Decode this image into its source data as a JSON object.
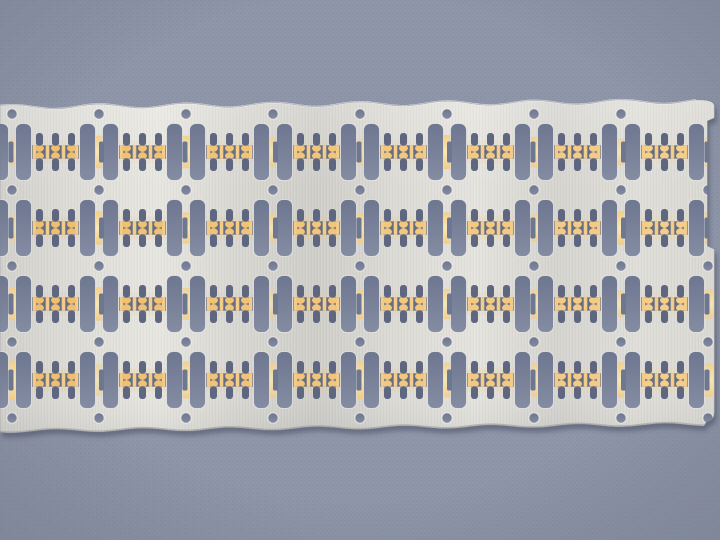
{
  "scene": {
    "type": "photograph",
    "subject": "Stamped metal semiconductor lead frame strip with selective gold plating, lying on a blue-gray woven surface",
    "lighting": "soft top light, slight shadow under lower edge, brushed-metal sheen"
  },
  "palette": {
    "background": "#8F96A8",
    "background_weave": "#838BA0",
    "vignette": "rgba(42,48,66,0.14)",
    "shadow": "#3A4054",
    "metal_stops": [
      "#D2D1CC",
      "#DEDDD7",
      "#E7E6E0",
      "#D8D7D1",
      "#CFCEC9",
      "#DCDBD5",
      "#E4E3DD",
      "#D5D4CF",
      "#DFDED8",
      "#D9D8D2"
    ],
    "metal_top_sheen": "rgba(255,255,255,0.20)",
    "metal_bottom_shade": "rgba(80,82,92,0.10)",
    "edge_highlight": "#F7F6F1",
    "edge_bottom": "#A9A9A6",
    "outline": "rgba(118,124,140,0.55)",
    "rim": "rgba(248,247,242,0.62)",
    "hole_top": "#6E7790",
    "hole_bottom": "#848CA2",
    "cluster_band": "#666E86",
    "cluster_hole": "#5E6680",
    "gold_lead_left": "#EFBD6C",
    "gold_lead_right": "#F5CF8C",
    "gold_bar": "#F2CC88",
    "strip_stops": [
      "#F3CE86",
      "#F9E8B8",
      "#F2CB82"
    ],
    "band_stops": [
      "#EFC27E",
      "#F3CA86",
      "#F7DA9A"
    ],
    "band_opacity_by_row": [
      0.15,
      0.3,
      0.19,
      0.31
    ]
  },
  "pattern": {
    "canvas": {
      "width": 720,
      "height": 540
    },
    "plate": {
      "top_y_left": 107,
      "top_slope": 6,
      "top_wave_amp": 2.2,
      "bottom_y_left": 431.5,
      "bottom_slope": 7,
      "bottom_wave_amp": 1.6,
      "right_x": 714.5,
      "notch_x": 707.5,
      "notch_y1": 121,
      "notch_y2": 246,
      "corner_step_y": 412,
      "corner_inset_x": 706.5,
      "corner_bottom_y": 422
    },
    "grid": {
      "hole_x0": 12,
      "pitch_x": 87,
      "hole_cols": 9,
      "hole_y0": 114,
      "pitch_y": 76,
      "hole_rows": 5,
      "lead_row_y0": 152,
      "lead_rows": 4,
      "cell_i_min": -1,
      "cell_i_max": 7,
      "sprocket_radius": 5.2,
      "skip_holes": [
        [
          8,
          0
        ]
      ]
    },
    "slot": {
      "body_half_in": 24,
      "body_half_out": 40,
      "body_h": 57,
      "body_rx": 6.5,
      "notch_w": 3.5,
      "notch_h": 21,
      "notch_rx": 1.8
    },
    "strip": {
      "base_w": 9,
      "base_h": 26,
      "rx": 3
    },
    "band": {
      "h": 23
    },
    "cluster": {
      "col_offsets": [
        -16,
        0,
        16
      ],
      "hole_w": 7,
      "hole_h": 12.8,
      "hole_gap": 6.2,
      "hole_rx": 3,
      "band_hw": 23.4,
      "band_hh": 6.6,
      "bar_xs": [
        -21,
        -8,
        8,
        21
      ],
      "bar_w": 3.6,
      "bar_rx": 1.2,
      "blob_hw": 4.4,
      "blob_hh": 6.8
    }
  }
}
